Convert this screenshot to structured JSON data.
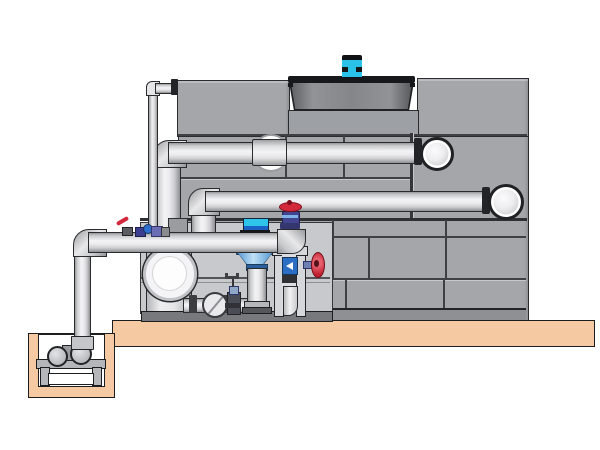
{
  "figure": {
    "type": "technical-illustration",
    "title": "Cooling tower installation with pump skid and sump pit — side elevation",
    "visible_text": [],
    "components": {
      "tower": {
        "label": "Cooling tower casing (panelled)"
      },
      "fan_cowl": {
        "label": "Fan cowl on tower roof"
      },
      "fan_motor": {
        "label": "Cyan fan drive motor"
      },
      "upper_pipe": {
        "label": "Upper horizontal pipe with elbow into tower"
      },
      "lower_pipe": {
        "label": "Lower horizontal pipe with elbow into tower"
      },
      "main_pipe": {
        "label": "Bottom suction header from sump riser"
      },
      "inline_pump": {
        "label": "Vertical inline pump with cyan motor"
      },
      "strainer": {
        "label": "Suction strainer cylinder with circular end cap"
      },
      "riser_valve": {
        "label": "Red-handwheel valve on riser tee"
      },
      "side_valve": {
        "label": "Red-handwheel side valve on frame"
      },
      "makeup_line": {
        "label": "Make-up line with check valve and gate valve"
      },
      "frame": {
        "label": "Pump support frame"
      },
      "skid": {
        "label": "Pump skid base and enclosure wall"
      },
      "slab": {
        "label": "Concrete slab"
      },
      "sump_pit": {
        "label": "Sump pit with pump stand"
      },
      "sump_pump": {
        "label": "Horizontal sump pump"
      },
      "riser": {
        "label": "Vertical riser pipe from sump"
      },
      "makeup_pipe_thin": {
        "label": "Thin make-up water pipe to tower top"
      }
    },
    "colors": {
      "background": "#ffffff",
      "panel_gray": "#a4a6aa",
      "cowl_gray": "#85868a",
      "pipe_light": "#ececee",
      "motor_cyan": "#2bc2e9",
      "pump_blue": "#2b6fc4",
      "valve_red": "#d3293d",
      "valve_blue": "#41448f",
      "slab_tan": "#f5c9a2",
      "seam_dark": "#3f4043"
    }
  }
}
